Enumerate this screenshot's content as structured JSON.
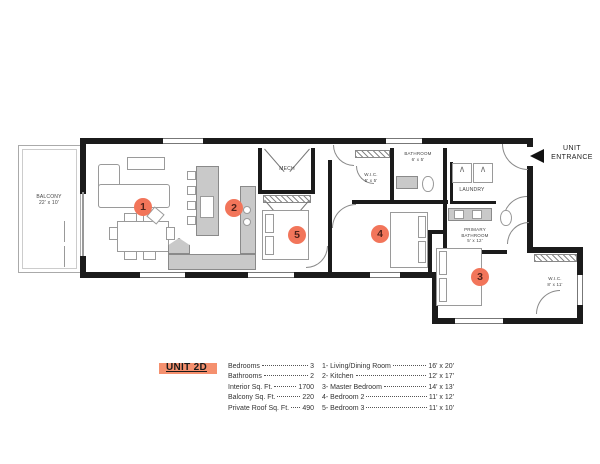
{
  "colors": {
    "marker": "#f2755a",
    "unit_highlight": "#f5906e",
    "wall": "#1b1b1b"
  },
  "icons": {
    "appliance_peak": "∧"
  },
  "plan": {
    "entrance": {
      "line1": "UNIT",
      "line2": "ENTRANCE"
    },
    "rooms": {
      "balcony": {
        "name": "BALCONY",
        "dims": "22' x 10'"
      },
      "mech": {
        "name": "MECH"
      },
      "wic_small": {
        "name": "W.I.C.",
        "dims": "5' x 5'"
      },
      "bathroom": {
        "name": "BATHROOM",
        "dims": "6' x 5'"
      },
      "laundry": {
        "name": "LAUNDRY"
      },
      "primary_bathroom": {
        "name1": "PRIMARY",
        "name2": "BATHROOM",
        "dims": "5' x 12'"
      },
      "wic_master": {
        "name": "W.I.C.",
        "dims": "8' x 11'"
      }
    },
    "markers": [
      {
        "num": "1"
      },
      {
        "num": "2"
      },
      {
        "num": "3"
      },
      {
        "num": "4"
      },
      {
        "num": "5"
      }
    ]
  },
  "legend": {
    "unit_label": "UNIT 2D",
    "stats": [
      {
        "label": "Bedrooms",
        "value": "3"
      },
      {
        "label": "Bathrooms",
        "value": "2"
      },
      {
        "label": "Interior Sq. Ft.",
        "value": "1700"
      },
      {
        "label": "Balcony Sq. Ft.",
        "value": "220"
      },
      {
        "label": "Private Roof Sq. Ft.",
        "value": "490"
      }
    ],
    "rooms": [
      {
        "label": "1- Living/Dining Room",
        "value": "16' x 20'"
      },
      {
        "label": "2- Kitchen",
        "value": "12' x 17'"
      },
      {
        "label": "3- Master Bedroom",
        "value": "14' x 13'"
      },
      {
        "label": "4- Bedroom 2",
        "value": "11' x 12'"
      },
      {
        "label": "5- Bedroom 3",
        "value": "11' x 10'"
      }
    ]
  }
}
